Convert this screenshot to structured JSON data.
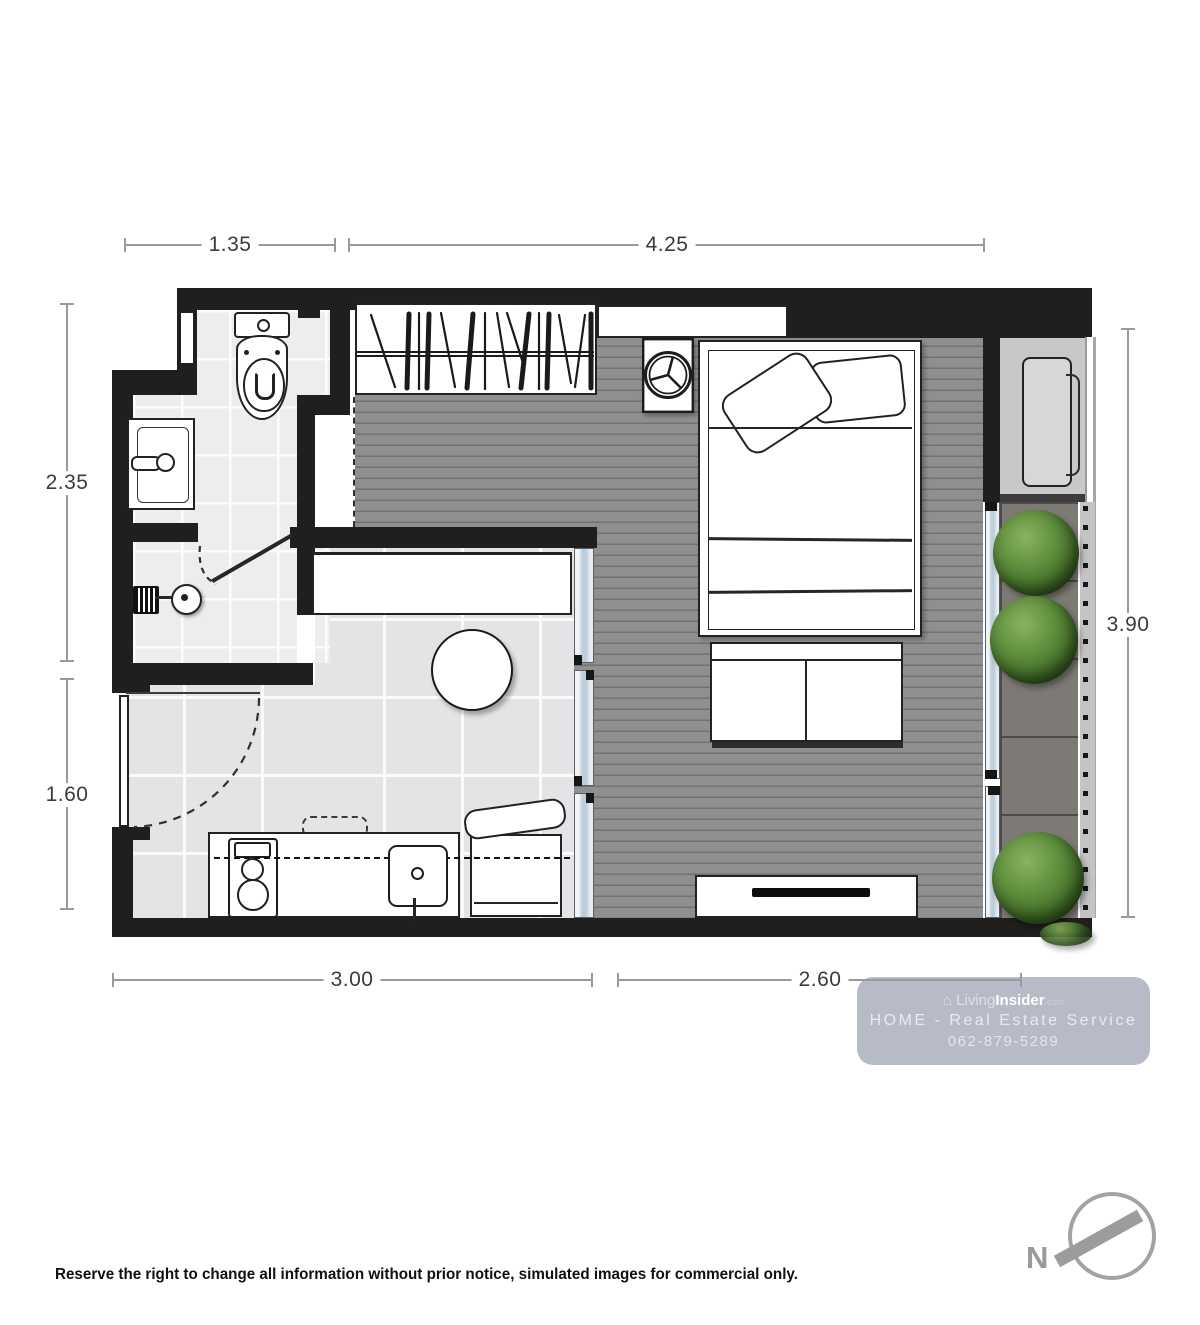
{
  "dims": {
    "top": [
      {
        "label": "1.35"
      },
      {
        "label": "4.25"
      }
    ],
    "left": [
      {
        "label": "2.35"
      },
      {
        "label": "1.60"
      }
    ],
    "right": [
      {
        "label": "3.90"
      }
    ],
    "bottom": [
      {
        "label": "3.00"
      },
      {
        "label": "2.60"
      }
    ]
  },
  "watermark": {
    "logo_glyph": "⌂",
    "brand_light": "Living",
    "brand_bold": "Insider",
    "brand_suffix": ".com",
    "service_line": "HOME - Real Estate Service",
    "phone": "062-879-5289"
  },
  "compass": {
    "north_label": "N"
  },
  "footer": {
    "disclaimer": "Reserve the right to change all information without prior notice, simulated images for commercial only."
  },
  "colors": {
    "wall": "#211e1e",
    "wood_floor": "#8f8f8f",
    "kitchen_tile": "#e4e4e6",
    "bath_tile": "#ededef",
    "balcony_floor": "#7d7a75",
    "glass": "#bfcedb",
    "plant_green": "#4e7a33",
    "watermark_bg": "#b1b5c3",
    "dim_line": "#9a9a9a",
    "north_gray": "#9a9a9a"
  }
}
